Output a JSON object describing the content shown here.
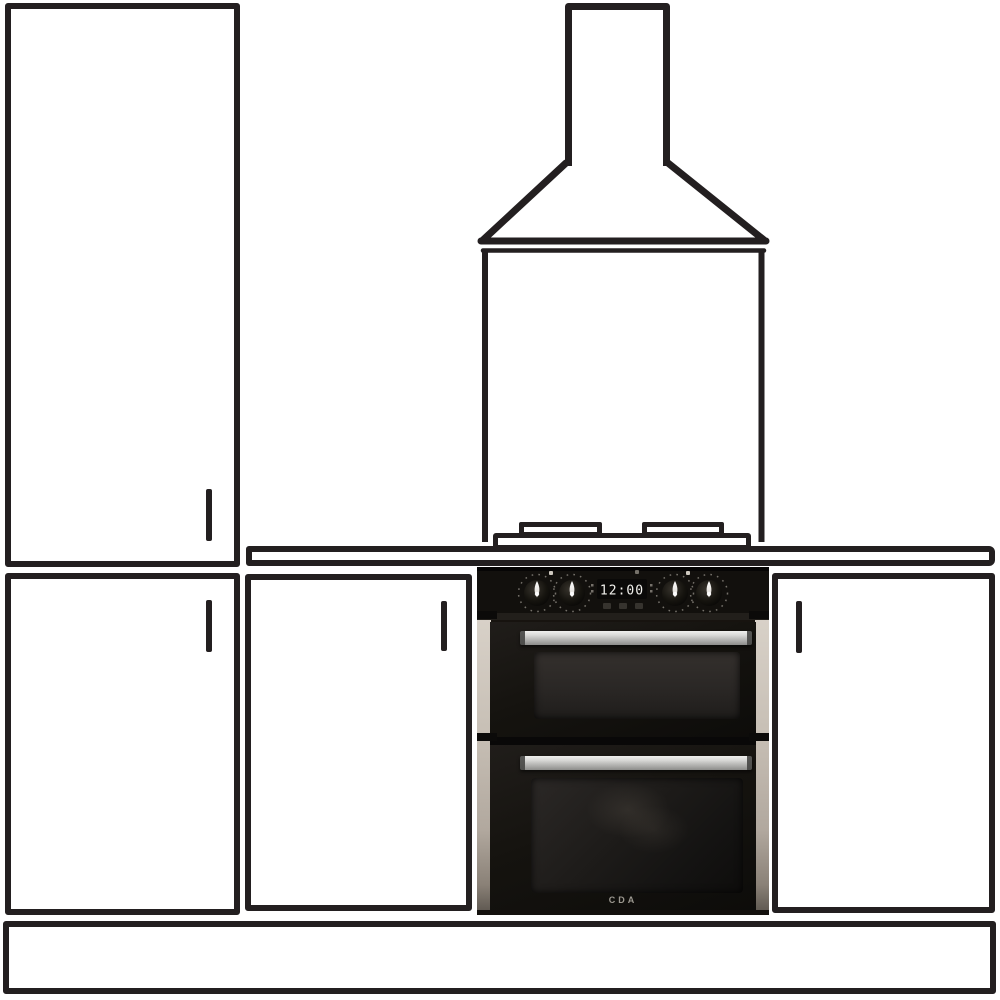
{
  "oven": {
    "brand": "CDA",
    "clock_display": "12:00"
  },
  "colors": {
    "line": "#231f20",
    "background": "#ffffff",
    "oven_body": "#17130f",
    "steel_light": "#f0f0ee",
    "steel_dark": "#8d8d8b",
    "trim": "#c7bfb5",
    "clock_text": "#f2f1ed"
  }
}
